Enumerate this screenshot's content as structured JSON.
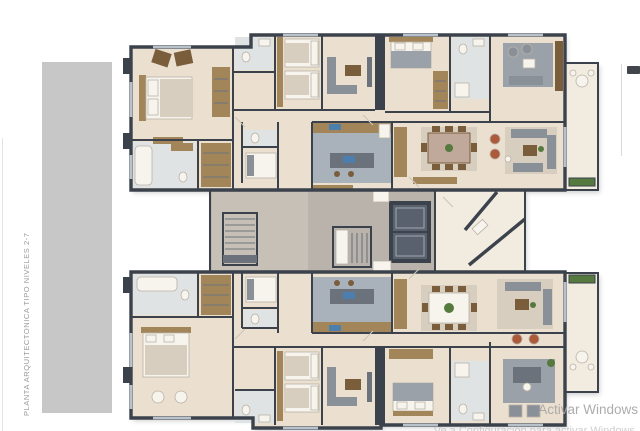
{
  "title_block": {
    "vertical_label": "PLANTA ARQUITECTONICA TIPO NIVELES 2-7"
  },
  "watermark": {
    "line1": "Activar Windows",
    "line2": "Ve a Configuración para activar Windows."
  },
  "colors": {
    "wall": "#3b424c",
    "floorMain": "#ebdfd0",
    "floorLight": "#f2ebdf",
    "tileBath": "#e0e3e4",
    "tileKitchen": "#a9b2ba",
    "coreFloor": "#b9b3ab",
    "coreLobby": "#c6c0b6",
    "wood": "#a3855a",
    "woodDark": "#7a5e3c",
    "white": "#f7f4ee",
    "sofaGray": "#8a9098",
    "sofaDark": "#6b727b",
    "rug": "#d8cec0",
    "rugGray": "#9ba1a8",
    "rust": "#ad5a3a",
    "plant": "#55793f",
    "blue": "#4d7fae",
    "elevator": "#59616e",
    "glass": "#b9c2cb",
    "band": "#c7c7c7",
    "watermarkColor": "#a6a6a6",
    "labelColor": "#9a9a9a"
  }
}
